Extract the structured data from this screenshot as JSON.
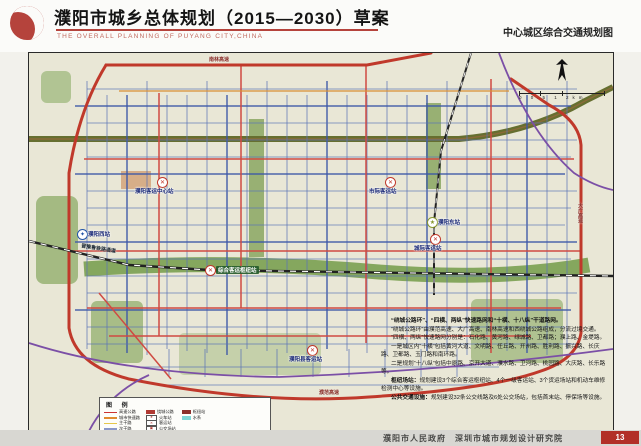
{
  "header": {
    "title": "濮阳市城乡总体规划（2015—2030）草案",
    "subtitle": "THE OVERALL PLANNING OF PUYANG CITY,CHINA",
    "map_name": "中心城区综合交通规划图"
  },
  "footer": {
    "credits": "濮阳市人民政府　深圳市城市规划设计研究院",
    "page_badge": "13"
  },
  "map": {
    "scale_text": "0  0.5  1  2km",
    "stations": [
      {
        "id": "puyang-west-railway-station",
        "name": "濮阳西站"
      },
      {
        "id": "passenger-center-station",
        "name": "濮阳客运中心站"
      },
      {
        "id": "intercity-coach-station-north",
        "name": "市际客运站"
      },
      {
        "id": "puyang-east-railway-station",
        "name": "濮阳东站"
      },
      {
        "id": "intercity-coach-station-east",
        "name": "城际客运站"
      },
      {
        "id": "comprehensive-hub-station",
        "name": "综合客运枢纽站"
      },
      {
        "id": "county-coach-station",
        "name": "濮阳县客运站"
      }
    ],
    "road_labels": {
      "ring_north": "南林高速",
      "ring_east": "大广高速",
      "ring_south": "濮范高速",
      "railway": "晋豫鲁铁路通道"
    },
    "notes": {
      "l1": "“绕城公路环”、“四横、两纵”快速路网和“十横、十八纵”干道路网。",
      "l2": "“绕城公路环”由濮范高速、大广高速、南林高速和西绕城公路组成，分流过境交通。",
      "l3": "“四横、两纵”快速路网分别是：石化路、黄河路、绿城路、卫都路；濮上路、金堤路。",
      "l4": "一是城区内“十横”包括黄河大道、文明路、任丘路、开州路、胜利路、振兴路、长庆路、卫都路、玉门路和南环路。",
      "l5": "二是规划“十八纵”包括中原路、京开大道、濮水路、卫河路、桃园路、大庆路、长乐路等。",
      "l6a": "枢纽场站：",
      "l6b": "规划建设3个综合客运枢纽站、4个一级客运站、3个货运场站和机动车维修检测中心等设施。",
      "l7a": "公共交通设施：",
      "l7b": "规划建设32条公交线路及6处公交场站，包括首末站、停保场等设施。"
    },
    "legend": {
      "title": "图  例",
      "col1": [
        {
          "label": "高速公路",
          "color": "#cc3333"
        },
        {
          "label": "城市快速路",
          "color": "#e08a2e"
        },
        {
          "label": "主干路",
          "color": "#e6c84a"
        },
        {
          "label": "次干路",
          "color": "#8a97c8"
        },
        {
          "label": "支路",
          "color": "#b9c2d8"
        }
      ],
      "col2": [
        {
          "label": "绕城公路",
          "color": "#b03a34"
        },
        {
          "label": "火车站",
          "glyph": "★"
        },
        {
          "label": "客运站",
          "glyph": "✕"
        },
        {
          "label": "公交场站",
          "glyph": "▣"
        },
        {
          "label": "货运场站",
          "glyph": "◆"
        }
      ],
      "col3": [
        {
          "label": "枢纽站",
          "color": "#8c2f2a"
        },
        {
          "label": "水系",
          "color": "#7fd6d6"
        }
      ]
    },
    "colors": {
      "map_background": "#e9e7d6",
      "arterial_red": "#c0392b",
      "grid_blue": "#5a73b6",
      "river_purple": "#7b4fa6",
      "green_corridor": "#7fa357",
      "railway_black": "#222222"
    }
  }
}
